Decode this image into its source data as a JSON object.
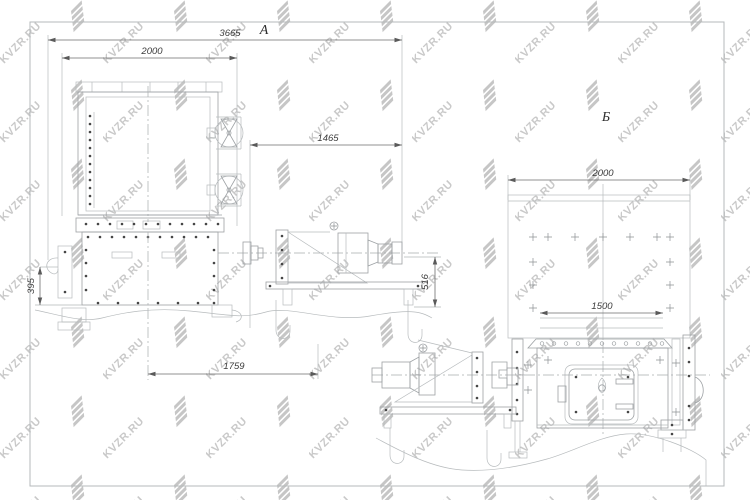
{
  "watermark": {
    "text": "KVZR.RU",
    "color": "#c9c9c9"
  },
  "drawing": {
    "type": "technical-drawing",
    "views": [
      {
        "label": "А",
        "dimensions": [
          {
            "name": "overall-length",
            "value": "3665"
          },
          {
            "name": "condenser-width",
            "value": "2000"
          },
          {
            "name": "drive-extension",
            "value": "1465"
          },
          {
            "name": "axis-height",
            "value": "516"
          },
          {
            "name": "side-offset",
            "value": "395"
          },
          {
            "name": "center-to-drive",
            "value": "1759"
          }
        ]
      },
      {
        "label": "Б",
        "dimensions": [
          {
            "name": "rear-panel-width",
            "value": "2000"
          },
          {
            "name": "body-width",
            "value": "1500"
          }
        ]
      }
    ]
  }
}
